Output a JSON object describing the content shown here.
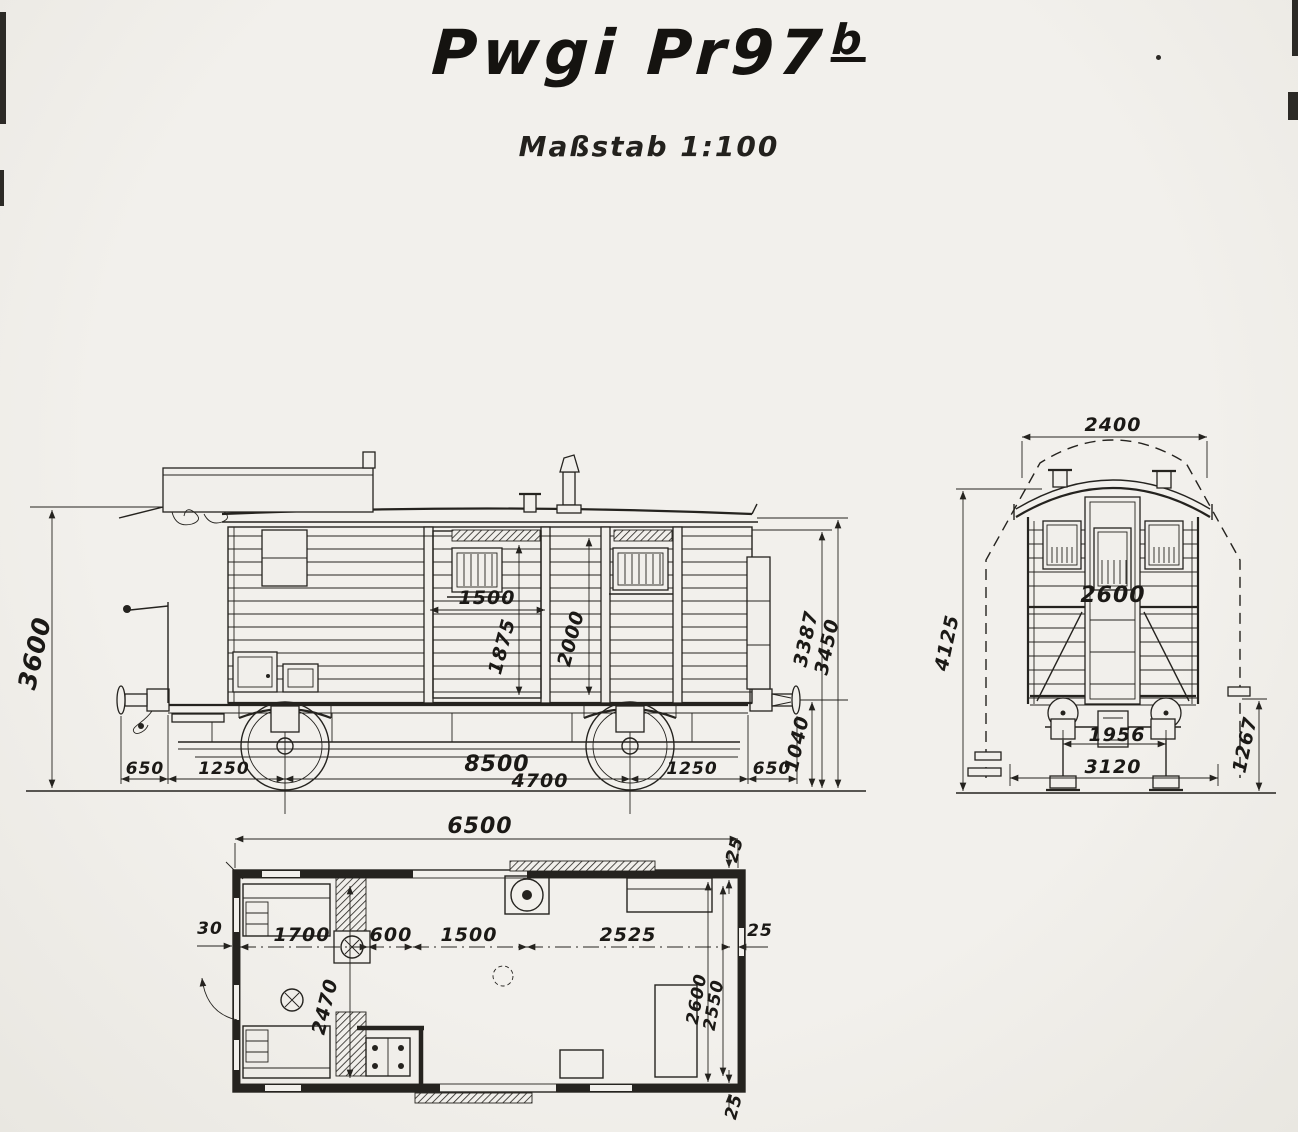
{
  "title": {
    "text": "Pwgi Pr97",
    "superscript": "b"
  },
  "subtitle": "Maßstab 1:100",
  "colors": {
    "paper": "#f1efeb",
    "ink": "#25231f"
  },
  "views": {
    "side": {
      "dims": {
        "overall_height": "3600",
        "door_width": "1500",
        "door_height": "1875",
        "wall_height": "2000",
        "eaves_height": "3387",
        "roof_height": "3450",
        "buffer_center_height": "1040",
        "buffer_left": "650",
        "overhang_left": "1250",
        "length_over_buffers": "8500",
        "wheelbase": "4700",
        "overhang_right": "1250",
        "buffer_right": "650"
      }
    },
    "front": {
      "dims": {
        "roof_width": "2400",
        "overall_height": "4125",
        "body_width": "2600",
        "wheel_gauge": "1956",
        "width_over_steps": "3120",
        "step_height": "1267"
      }
    },
    "plan": {
      "dims": {
        "interior_length": "6500",
        "end_wall": "30",
        "compartment": "1700",
        "lobby": "600",
        "door_opening": "1500",
        "freight_room": "2525",
        "side_wall_right": "25",
        "compartment_width": "2470",
        "interior_width": "2600",
        "clear_width": "2550",
        "wall_top": "25",
        "wall_bottom": "25"
      }
    }
  }
}
